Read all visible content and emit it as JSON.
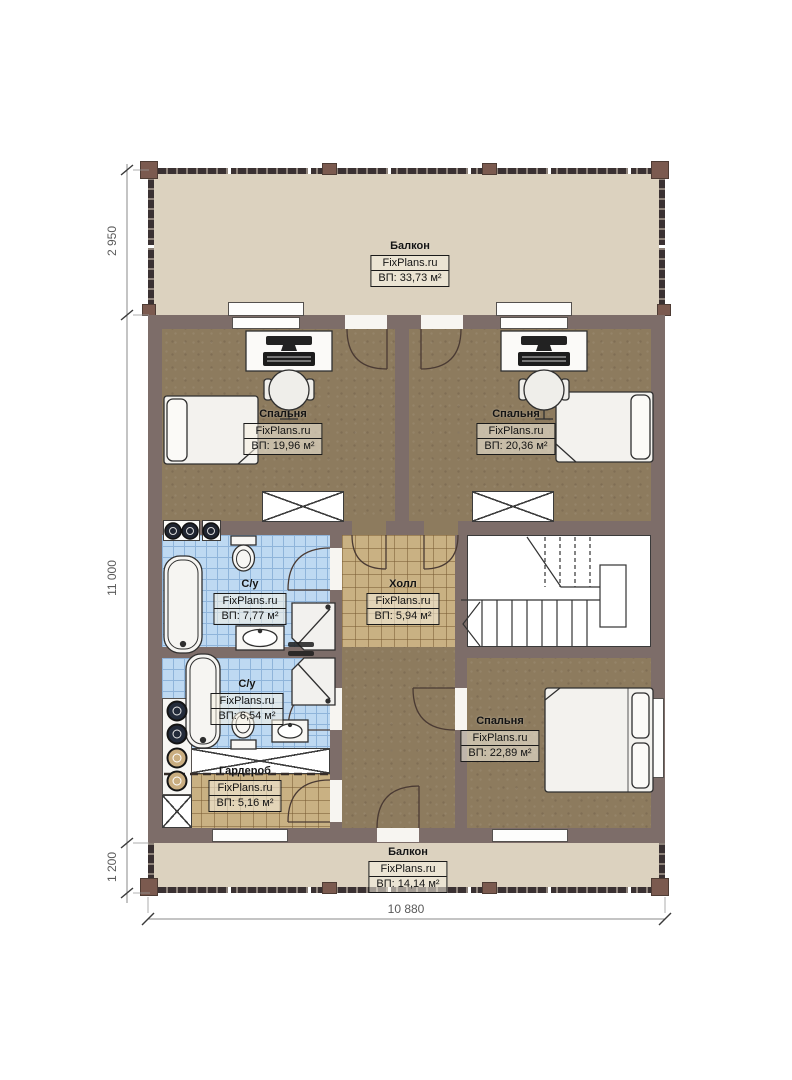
{
  "watermark": "FixPlans.ru",
  "rooms": [
    {
      "key": "balcony-top",
      "name": "Балкон",
      "area": "ВП: 33,73 м²"
    },
    {
      "key": "bedroom-top-left",
      "name": "Спальня",
      "area": "ВП: 19,96 м²"
    },
    {
      "key": "bedroom-top-right",
      "name": "Спальня",
      "area": "ВП: 20,36 м²"
    },
    {
      "key": "bathroom-upper",
      "name": "С/у",
      "area": "ВП: 7,77 м²"
    },
    {
      "key": "hall",
      "name": "Холл",
      "area": "ВП: 5,94 м²"
    },
    {
      "key": "bathroom-lower",
      "name": "С/у",
      "area": "ВП: 6,54 м²"
    },
    {
      "key": "wardrobe",
      "name": "Гардероб",
      "area": "ВП: 5,16 м²"
    },
    {
      "key": "bedroom-bottom",
      "name": "Спальня",
      "area": "ВП: 22,89 м²"
    },
    {
      "key": "balcony-bottom",
      "name": "Балкон",
      "area": "ВП: 14,14 м²"
    }
  ],
  "dimensions": {
    "left_top": "2 950",
    "left_middle": "11 000",
    "left_bottom": "1 200",
    "bottom_width": "10 880"
  },
  "colors": {
    "wall": "#7d6d69",
    "bedroom_floor": "#8d7b5e",
    "bathroom_floor": "#bed9f2",
    "hall_floor": "#c9b183",
    "balcony_floor": "#dcd2bf",
    "railing": "#3a3132",
    "stairs_floor": "#ffffff",
    "furniture": "#f5f4f1"
  }
}
